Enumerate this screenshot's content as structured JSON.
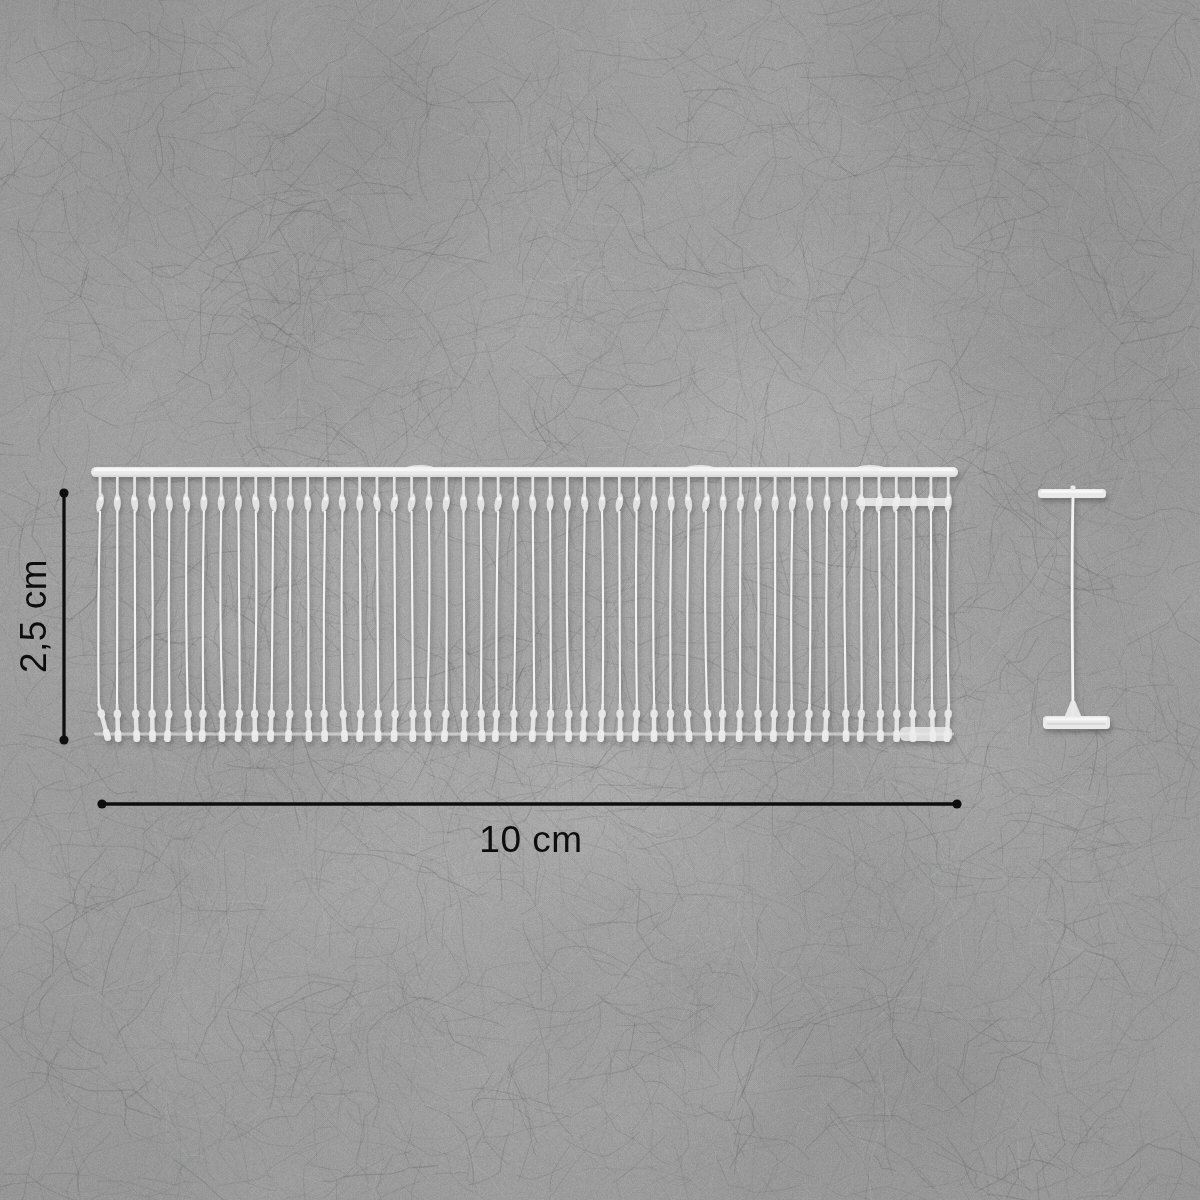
{
  "scene": {
    "description": "Strip of 50 transparent plastic tag-pin fasteners (tagging barbs) plus one detached single tag pin, lying on a gray felt background, annotated with dimension lines",
    "measurements": {
      "height_label": "2,5 cm",
      "width_label": "10 cm"
    },
    "dimension_style": {
      "color": "#0e0e0e",
      "line_width": 3.3,
      "dot_radius": 4.6,
      "vertical": {
        "x": 64,
        "y1": 493,
        "y2": 740
      },
      "horizontal": {
        "y": 804,
        "x1": 102,
        "x2": 957
      }
    },
    "comb": {
      "pin_count": 50,
      "first_pin_x": 100,
      "pin_spacing": 17.31,
      "rail": {
        "x1": 91,
        "x2": 958,
        "y": 467,
        "h": 10
      },
      "neck_bottom": 495,
      "head_top": 493,
      "head_bottom": 513,
      "filament_bottom": 706,
      "paddle_bottom": 742,
      "connector_y": 734,
      "right_bar": {
        "x1": 856,
        "x2": 950,
        "y": 498,
        "h": 8
      }
    },
    "single_pin": {
      "cx": 1073,
      "top_bar": {
        "x": 1038,
        "y": 489,
        "w": 68,
        "h": 9
      },
      "bottom_bar": {
        "x": 1043,
        "y": 716,
        "w": 67,
        "h": 13
      },
      "stem_top": 497,
      "stem_bottom": 717
    },
    "background": {
      "base_rgb": [
        168,
        168,
        168
      ],
      "fiber_dark": "58,60,62",
      "fiber_light": "240,241,241"
    },
    "plastic": {
      "bright": "#f6f6f6",
      "mid": "#e9e9e9",
      "head": "#e4e4e4",
      "shade": "#8a8a8a"
    }
  }
}
